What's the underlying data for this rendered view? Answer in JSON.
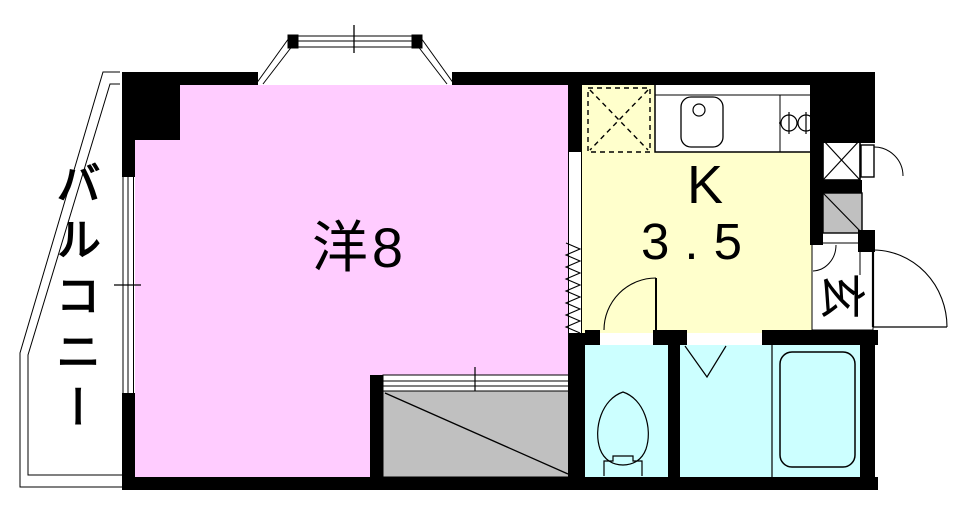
{
  "floorplan": {
    "layout_type": "1K apartment floor plan",
    "labels": {
      "western_room": "洋8",
      "kitchen_letter": "K",
      "kitchen_size": "3.5",
      "entrance": "玄",
      "balcony": "バルコニー"
    },
    "colors": {
      "wall": "#000000",
      "western_room": "#FFCCFF",
      "kitchen": "#FFFFCC",
      "wet_area": "#CCFFFF",
      "closet": "#C0C0C0",
      "floor_white": "#FFFFFF"
    },
    "fixtures": [
      "bay-window",
      "balcony-railing",
      "window",
      "refrigerator-space",
      "kitchen-counter",
      "sink",
      "gas-burner",
      "pipe-space-box",
      "meter-box-door",
      "shoe-cabinet",
      "entrance-door",
      "kitchen-door",
      "accordion-partition",
      "closet-sliding-door",
      "toilet",
      "folding-door-mark",
      "bathtub"
    ]
  }
}
